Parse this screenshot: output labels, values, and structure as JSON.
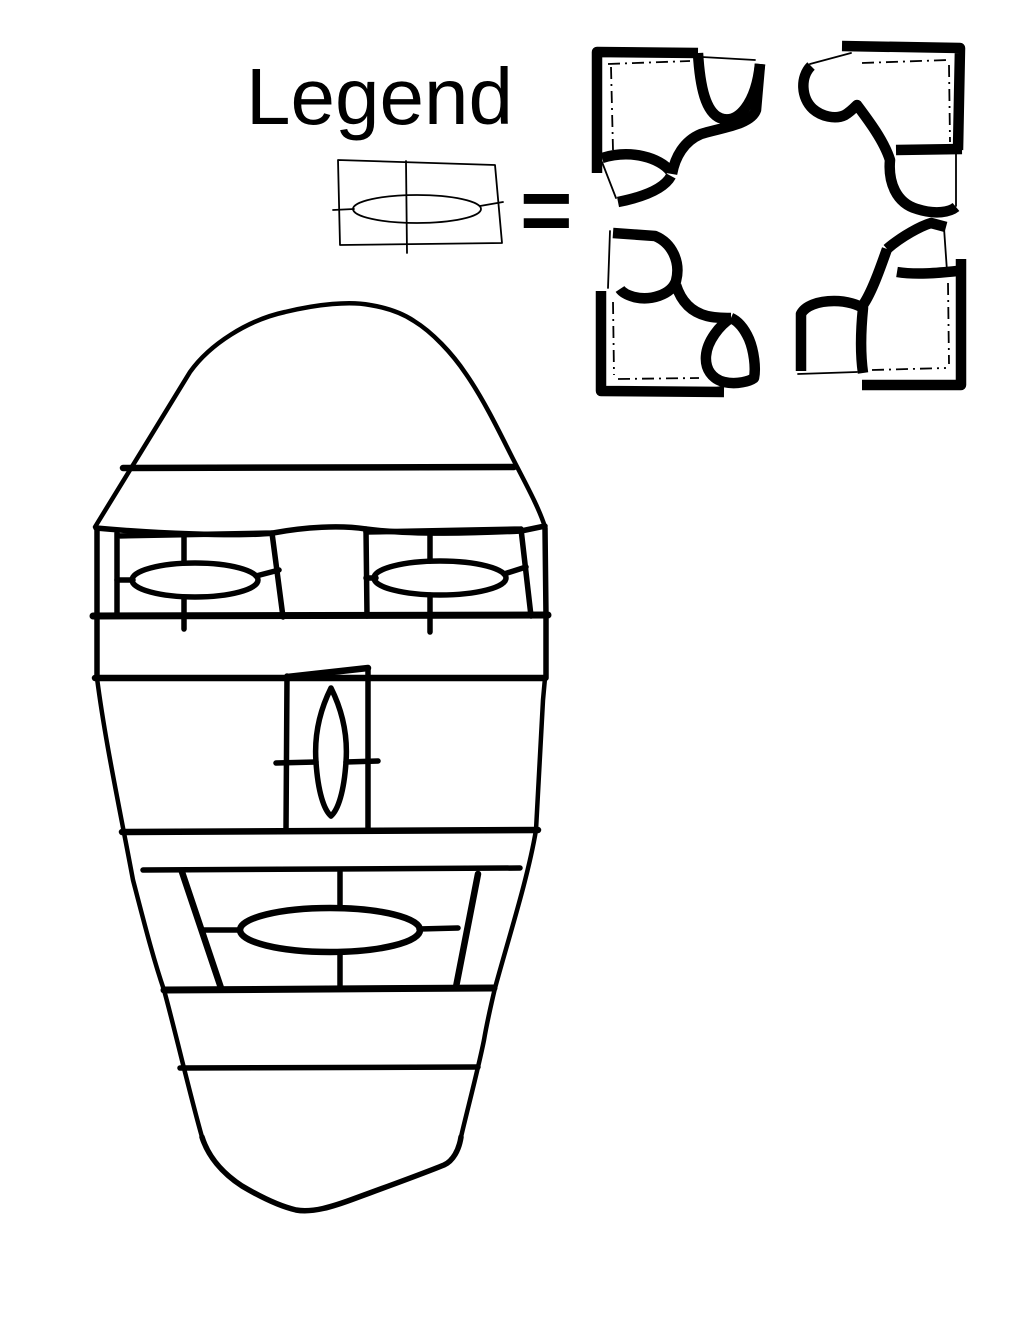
{
  "canvas": {
    "width": 1020,
    "height": 1320,
    "background_color": "#ffffff",
    "ink_color": "#000000"
  },
  "legend": {
    "title": "Legend",
    "equals_sign": "="
  }
}
